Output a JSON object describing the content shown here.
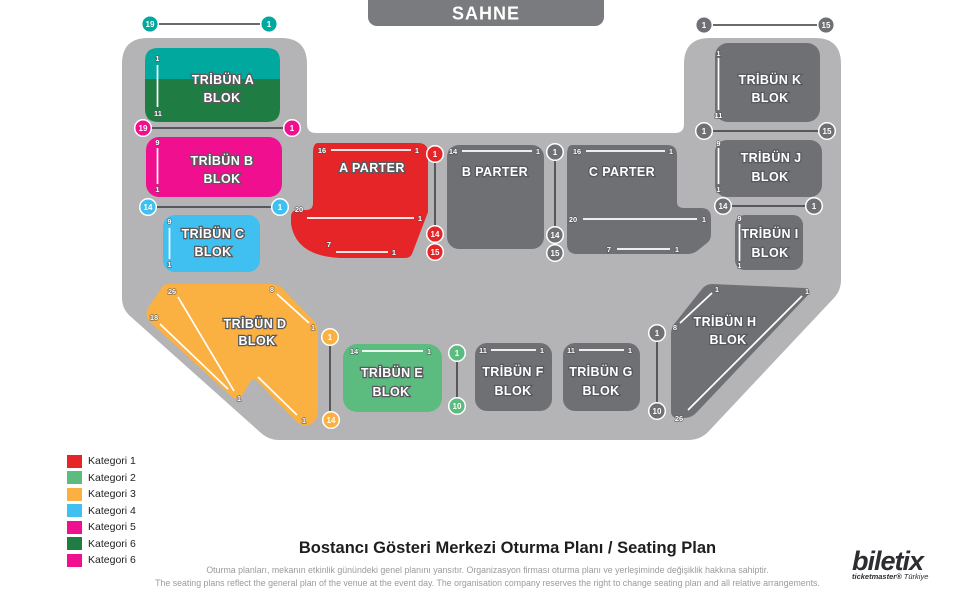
{
  "stage": {
    "label": "SAHNE"
  },
  "palette": {
    "floor_gray": "#b4b4b6",
    "block_gray": "#6f7073",
    "banner_gray": "#7a7b7e",
    "red": "#e52528",
    "green": "#5cbc80",
    "yellow": "#fbb042",
    "cyan": "#3fc0f0",
    "magenta": "#f0108f",
    "dark_green": "#1f7d44",
    "teal": "#00a89e"
  },
  "blocks": {
    "a": {
      "l1": "TRİBÜN A",
      "l2": "BLOK"
    },
    "b": {
      "l1": "TRİBÜN B",
      "l2": "BLOK"
    },
    "c": {
      "l1": "TRİBÜN C",
      "l2": "BLOK"
    },
    "d": {
      "l1": "TRİBÜN D",
      "l2": "BLOK"
    },
    "e": {
      "l1": "TRİBÜN E",
      "l2": "BLOK"
    },
    "f": {
      "l1": "TRİBÜN F",
      "l2": "BLOK"
    },
    "g": {
      "l1": "TRİBÜN G",
      "l2": "BLOK"
    },
    "h": {
      "l1": "TRİBÜN H",
      "l2": "BLOK"
    },
    "i": {
      "l1": "TRİBÜN I",
      "l2": "BLOK"
    },
    "j": {
      "l1": "TRİBÜN J",
      "l2": "BLOK"
    },
    "k": {
      "l1": "TRİBÜN K",
      "l2": "BLOK"
    },
    "aparter": {
      "l1": "A PARTER"
    },
    "bparter": {
      "l1": "B PARTER"
    },
    "cparter": {
      "l1": "C PARTER"
    }
  },
  "rows": {
    "a": [
      "1",
      "11"
    ],
    "b": [
      "9",
      "1"
    ],
    "c": [
      "9",
      "1"
    ],
    "k": [
      "1",
      "11"
    ],
    "j": [
      "9",
      "1"
    ],
    "i": [
      "9",
      "1"
    ],
    "e": [
      "14",
      "1"
    ],
    "f": [
      "11",
      "1"
    ],
    "g": [
      "11",
      "1"
    ],
    "bparter": [
      "14",
      "1"
    ],
    "aparter": {
      "top": [
        "16",
        "1"
      ],
      "mid": [
        "20",
        "1"
      ],
      "bot": [
        "7",
        "1"
      ]
    },
    "cparter": {
      "top": [
        "16",
        "1"
      ],
      "mid": [
        "20",
        "1"
      ],
      "bot": [
        "7",
        "1"
      ]
    },
    "d": {
      "outer": [
        "26",
        "1"
      ],
      "inner": [
        "18"
      ],
      "right": [
        "8",
        "1"
      ],
      "long": [
        "1"
      ]
    },
    "h": {
      "short": [
        "1",
        "8"
      ],
      "long": [
        "1",
        "26"
      ]
    }
  },
  "badges": {
    "a_top": [
      "19",
      "1"
    ],
    "ab": [
      "19",
      "1"
    ],
    "bc": [
      "14",
      "1"
    ],
    "aparter_right": [
      "1",
      "14",
      "15"
    ],
    "bparter_right": [
      "1",
      "14",
      "15"
    ],
    "k_top": [
      "1",
      "15"
    ],
    "kj": [
      "1",
      "15"
    ],
    "ji": [
      "14",
      "1"
    ],
    "d_right": [
      "1",
      "14"
    ],
    "e_right": [
      "1",
      "10"
    ],
    "g_right": [
      "1",
      "10"
    ]
  },
  "legend": [
    {
      "label": "Kategori 1",
      "color": "#e52528"
    },
    {
      "label": "Kategori 2",
      "color": "#5cbc80"
    },
    {
      "label": "Kategori 3",
      "color": "#fbb042"
    },
    {
      "label": "Kategori 4",
      "color": "#3fc0f0"
    },
    {
      "label": "Kategori 5",
      "color": "#f0108f"
    },
    {
      "label": "Kategori 6",
      "color": "#1f7d44"
    },
    {
      "label": "Kategori 6",
      "color": "#f0108f"
    }
  ],
  "footer": {
    "title": "Bostancı Gösteri Merkezi Oturma Planı / Seating Plan",
    "disclaimer_tr": "Oturma planları, mekanın etkinlik günündeki genel planını yansıtır. Organizasyon firması oturma planı ve yerleşiminde değişiklik hakkına sahiptir.",
    "disclaimer_en": "The seating plans reflect the general plan of the venue at the event day. The organisation company reserves the right to change seating plan and all relative arrangements.",
    "brand": "biletix",
    "brand_sub_bold": "ticketmaster®",
    "brand_sub_light": " Türkiye"
  }
}
